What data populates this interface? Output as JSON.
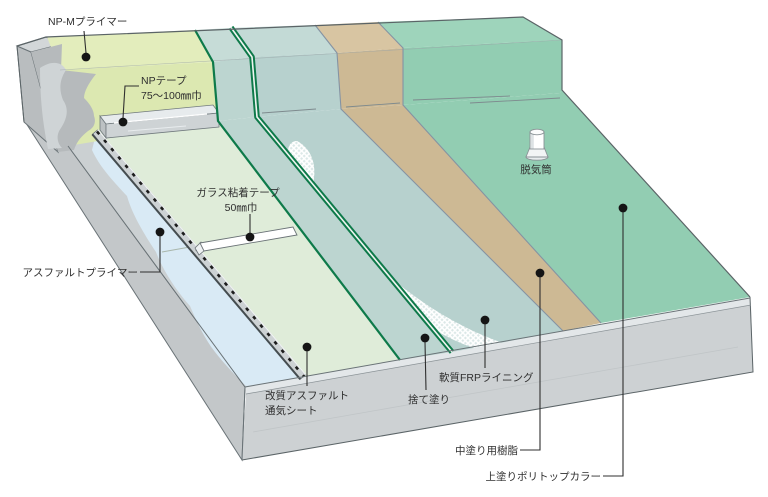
{
  "diagram": {
    "type": "isometric-cutaway-roof-waterproofing-layers",
    "labels": {
      "np_m_primer": "NP-Mプライマー",
      "np_tape": "NPテープ",
      "np_tape_width": "75〜100㎜巾",
      "glass_tape": "ガラス粘着テープ",
      "glass_tape_width": "50㎜巾",
      "asphalt_primer": "アスファルトプライマー",
      "sheet_1": "改質アスファルト",
      "sheet_2": "通気シート",
      "sutenuri": "捨て塗り",
      "frp_lining": "軟質FRPライニング",
      "vent_cylinder": "脱気筒",
      "nakanuri": "中塗り用樹脂",
      "uwanuri": "上塗りポリトップカラー"
    },
    "colors": {
      "background": "#ffffff",
      "concrete_front": "#cdd1d3",
      "concrete_left": "#c3c7c9",
      "concrete_wall": "#b6babc",
      "concrete_top": "#d3d7d9",
      "np_m_primer": "#dce8b1",
      "asphalt_primer_blue": "#d9eaf5",
      "sheet": "#dfecd9",
      "np_tape_gray": "#ced3d5",
      "glass_tape_white": "#ffffff",
      "sutenuri": "#bcd5d0",
      "frp": "#b7d1ce",
      "frp_edge_green": "#0e7a4a",
      "nakanuri_tan": "#cdb994",
      "uwanuri_green": "#92cdb2",
      "outline": "#5b6467",
      "label": "#2f2f2f"
    }
  }
}
